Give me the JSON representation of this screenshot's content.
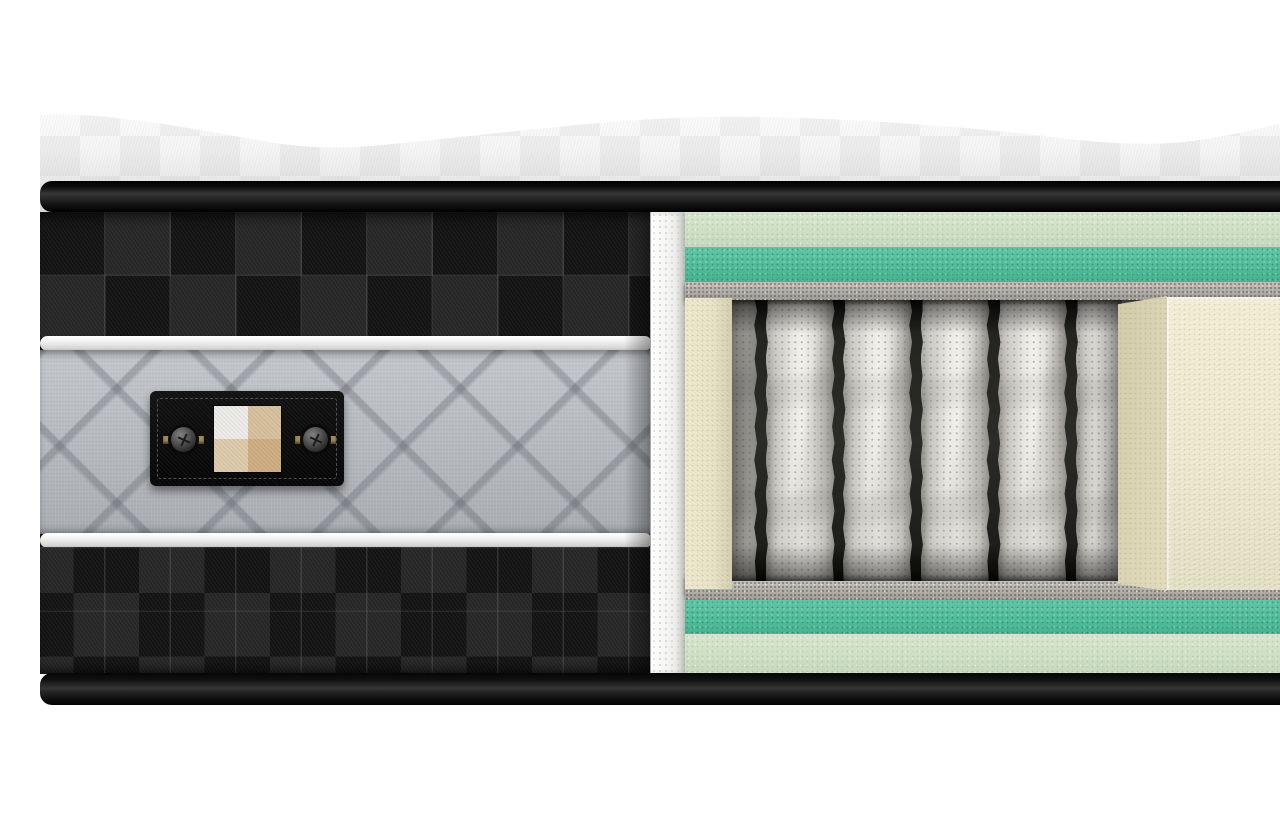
{
  "scene": {
    "name": "mattress-cross-section-cutaway",
    "description": "Product render of a hybrid mattress with the right half cut away to expose internal layers: quilted wavy pillow top, black checkered side fabric with gray quilted band and black care label, and a cutaway showing green foam comfort layers, felt insulator pads, fabric-wrapped pocket springs and cream foam encasement rails.",
    "visible_text": "",
    "background_color": "#ffffff"
  },
  "colors": {
    "background": "#ffffff",
    "pillow_top_fabric": "#f2f2f2",
    "rim_black": "#151515",
    "checker_dark": "#131313",
    "checker_light": "#262626",
    "piping_white": "#efefef",
    "quilt_gray": "#b6b9be",
    "label_black": "#0b0b0b",
    "button_gray": "#4c4c4c",
    "button_tab_brass": "#a18a5e",
    "swatch_tl": "#edece8",
    "swatch_tr": "#d8c19e",
    "swatch_bl": "#ddcbab",
    "swatch_br": "#cfae83",
    "cut_edge_white": "#f3f3f1",
    "cut_edge_dot": "#d7d7d3",
    "foam_mint": "#cfdfc6",
    "foam_teal": "#52bc9a",
    "felt_gray": "#b0aca6",
    "spring_fabric": "#e9e7e2",
    "spring_gap_dark": "#171715",
    "foam_cream": "#eae4c9",
    "foam_cream_front": "#ece6cb",
    "foam_cream_side": "#dcd5b7"
  },
  "left_panel": {
    "fabric": "black checkered twill side panel",
    "bands": [
      "checker-top",
      "white-piping",
      "gray-quilted-band",
      "white-piping",
      "checker-bottom"
    ],
    "label": {
      "text": "",
      "background": "#0b0b0b",
      "buttons": 2,
      "swatch": {
        "top_left": "#edece8",
        "top_right": "#d8c19e",
        "bottom_left": "#ddcbab",
        "bottom_right": "#cfae83"
      }
    }
  },
  "cutaway": {
    "layers_top": [
      {
        "name": "comfort foam (mint)",
        "color": "#cfdfc6",
        "height_px": 35
      },
      {
        "name": "transition foam (teal)",
        "color": "#52bc9a",
        "height_px": 35
      },
      {
        "name": "insulator felt pad",
        "color": "#b0aca6",
        "height_px": 18
      }
    ],
    "springs": {
      "type": "fabric-wrapped pocket coils",
      "visible_count": 6,
      "render_count": 9,
      "pitch_px": 77.5,
      "gap_px": 8.5
    },
    "foam_rail_left": {
      "color": "#eae4c9"
    },
    "foam_encasement_right": {
      "front_color": "#ece6cb",
      "side_color": "#dcd5b7"
    },
    "layers_bottom": [
      {
        "name": "insulator felt pad",
        "color": "#b0aca6",
        "height_px": 19
      },
      {
        "name": "transition foam (teal)",
        "color": "#52bc9a",
        "height_px": 34
      },
      {
        "name": "base foam (mint)",
        "color": "#cfdfc6",
        "height_px": 40
      }
    ]
  }
}
